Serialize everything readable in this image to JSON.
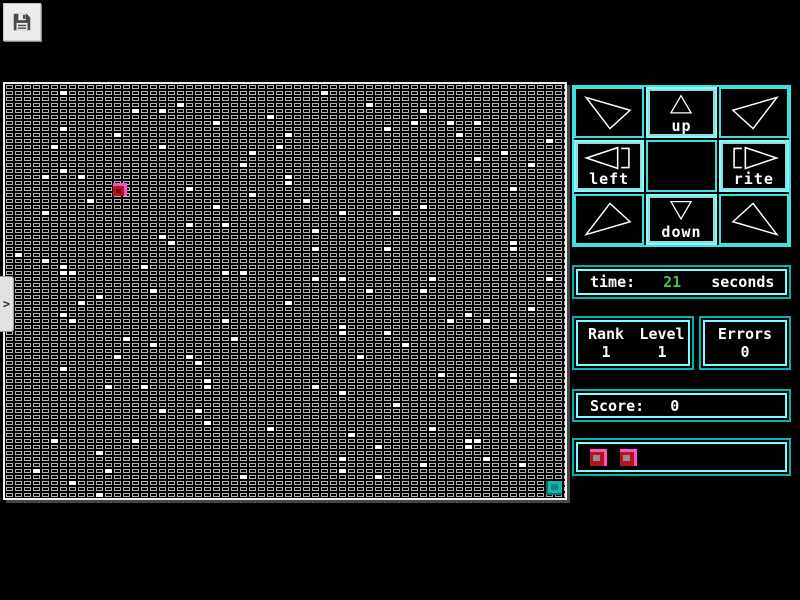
{
  "toolbar": {
    "save_button": "save"
  },
  "sidebar_tab": {
    "chevron": ">"
  },
  "dpad": {
    "up": "up",
    "down": "down",
    "left": "left",
    "rite": "rite"
  },
  "time_panel": {
    "label": "time:",
    "value": "21",
    "unit": "seconds"
  },
  "stats_panel": {
    "rank_label": "Rank",
    "level_label": "Level",
    "rank_value": "1",
    "level_value": "1",
    "errors_label": "Errors",
    "errors_value": "0"
  },
  "score_panel": {
    "label": "Score:",
    "value": "0"
  },
  "grid": {
    "cols": 63,
    "rows": 69,
    "cell_width": 9,
    "cell_height": 6,
    "white_cells": [
      [
        6,
        1
      ],
      [
        19,
        3
      ],
      [
        14,
        4
      ],
      [
        17,
        4
      ],
      [
        6,
        7
      ],
      [
        12,
        8
      ],
      [
        5,
        10
      ],
      [
        17,
        10
      ],
      [
        6,
        14
      ],
      [
        4,
        15
      ],
      [
        8,
        15
      ],
      [
        20,
        17
      ],
      [
        9,
        19
      ],
      [
        4,
        21
      ],
      [
        20,
        23
      ],
      [
        17,
        25
      ],
      [
        18,
        26
      ],
      [
        1,
        28
      ],
      [
        4,
        29
      ],
      [
        6,
        30
      ],
      [
        15,
        30
      ],
      [
        6,
        31
      ],
      [
        7,
        31
      ],
      [
        35,
        1
      ],
      [
        40,
        3
      ],
      [
        29,
        5
      ],
      [
        23,
        6
      ],
      [
        42,
        7
      ],
      [
        31,
        8
      ],
      [
        30,
        10
      ],
      [
        27,
        11
      ],
      [
        26,
        13
      ],
      [
        31,
        15
      ],
      [
        31,
        16
      ],
      [
        27,
        18
      ],
      [
        33,
        19
      ],
      [
        23,
        20
      ],
      [
        37,
        21
      ],
      [
        24,
        23
      ],
      [
        34,
        24
      ],
      [
        34,
        27
      ],
      [
        24,
        31
      ],
      [
        26,
        31
      ],
      [
        34,
        32
      ],
      [
        37,
        32
      ],
      [
        40,
        34
      ],
      [
        46,
        4
      ],
      [
        45,
        6
      ],
      [
        49,
        6
      ],
      [
        52,
        6
      ],
      [
        50,
        8
      ],
      [
        60,
        9
      ],
      [
        55,
        11
      ],
      [
        52,
        12
      ],
      [
        58,
        13
      ],
      [
        56,
        17
      ],
      [
        46,
        20
      ],
      [
        43,
        21
      ],
      [
        56,
        26
      ],
      [
        42,
        27
      ],
      [
        56,
        27
      ],
      [
        47,
        32
      ],
      [
        60,
        32
      ],
      [
        16,
        34
      ],
      [
        10,
        35
      ],
      [
        8,
        36
      ],
      [
        6,
        38
      ],
      [
        7,
        39
      ],
      [
        13,
        42
      ],
      [
        16,
        43
      ],
      [
        12,
        45
      ],
      [
        20,
        45
      ],
      [
        6,
        47
      ],
      [
        11,
        50
      ],
      [
        15,
        50
      ],
      [
        17,
        54
      ],
      [
        5,
        59
      ],
      [
        14,
        59
      ],
      [
        10,
        61
      ],
      [
        3,
        64
      ],
      [
        11,
        64
      ],
      [
        7,
        66
      ],
      [
        10,
        68
      ],
      [
        31,
        36
      ],
      [
        24,
        39
      ],
      [
        37,
        40
      ],
      [
        37,
        41
      ],
      [
        25,
        42
      ],
      [
        39,
        45
      ],
      [
        21,
        46
      ],
      [
        22,
        49
      ],
      [
        22,
        50
      ],
      [
        34,
        50
      ],
      [
        37,
        51
      ],
      [
        21,
        54
      ],
      [
        22,
        56
      ],
      [
        29,
        57
      ],
      [
        38,
        58
      ],
      [
        41,
        60
      ],
      [
        37,
        62
      ],
      [
        37,
        64
      ],
      [
        26,
        65
      ],
      [
        41,
        65
      ],
      [
        46,
        34
      ],
      [
        58,
        37
      ],
      [
        51,
        38
      ],
      [
        49,
        39
      ],
      [
        53,
        39
      ],
      [
        42,
        41
      ],
      [
        44,
        43
      ],
      [
        48,
        48
      ],
      [
        56,
        48
      ],
      [
        56,
        49
      ],
      [
        43,
        53
      ],
      [
        47,
        57
      ],
      [
        51,
        59
      ],
      [
        52,
        59
      ],
      [
        51,
        60
      ],
      [
        53,
        62
      ],
      [
        46,
        63
      ],
      [
        57,
        63
      ]
    ],
    "player": {
      "x": 108,
      "y": 99,
      "w": 14,
      "h": 13
    },
    "goal": {
      "x": 541,
      "y": 397,
      "w": 16,
      "h": 14
    }
  },
  "colors": {
    "cyan": "#3fe0e0",
    "cyan_bright": "#7dffff",
    "cyan_dark": "#00b4b4",
    "green": "#3fbf4f",
    "red": "#b5121f",
    "magenta": "#ff4fc4",
    "teal": "#17b3ad",
    "cell_gray": "#b2b2b2",
    "white": "#ffffff"
  }
}
